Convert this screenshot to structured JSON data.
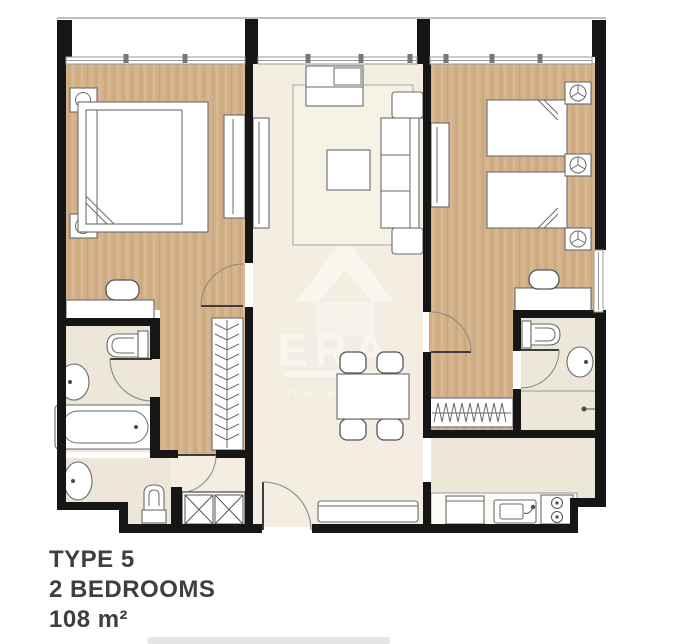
{
  "page": {
    "background": "#ffffff"
  },
  "floor_plan": {
    "watermark": {
      "brand": "ERA",
      "tagline": "REAL ESTATE"
    },
    "colors": {
      "page_bg": "#ffffff",
      "wall": "#161616",
      "wood_floor": "#d3b088",
      "cream_floor": "#f3eee1",
      "bath_floor": "#ece7d9",
      "rug": "#f7f2e6",
      "outline": "#6a6a6a"
    }
  },
  "caption": {
    "type": "TYPE 5",
    "bedrooms": "2 BEDROOMS",
    "area": "108 m²"
  }
}
